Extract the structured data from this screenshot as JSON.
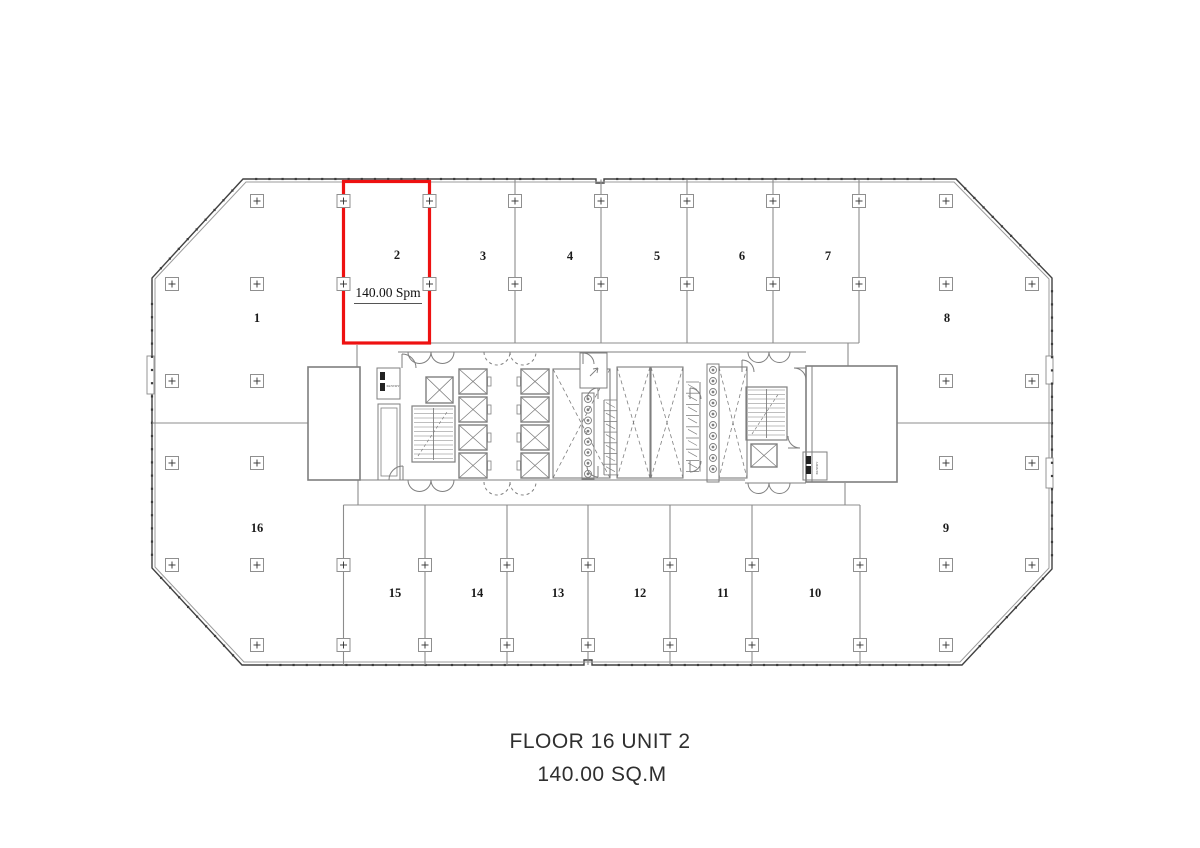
{
  "title": {
    "line1": "FLOOR 16 UNIT 2",
    "line2": "140.00 SQ.M"
  },
  "highlighted_unit": {
    "number": "2",
    "area_label": "140.00 Spm",
    "color": "#ee1111"
  },
  "units": [
    {
      "number": "1",
      "x": 257,
      "y": 322
    },
    {
      "number": "2",
      "x": 397,
      "y": 259
    },
    {
      "number": "3",
      "x": 483,
      "y": 260
    },
    {
      "number": "4",
      "x": 570,
      "y": 260
    },
    {
      "number": "5",
      "x": 657,
      "y": 260
    },
    {
      "number": "6",
      "x": 742,
      "y": 260
    },
    {
      "number": "7",
      "x": 828,
      "y": 260
    },
    {
      "number": "8",
      "x": 947,
      "y": 322
    },
    {
      "number": "9",
      "x": 946,
      "y": 532
    },
    {
      "number": "10",
      "x": 815,
      "y": 597
    },
    {
      "number": "11",
      "x": 723,
      "y": 597
    },
    {
      "number": "12",
      "x": 640,
      "y": 597
    },
    {
      "number": "13",
      "x": 558,
      "y": 597
    },
    {
      "number": "14",
      "x": 477,
      "y": 597
    },
    {
      "number": "15",
      "x": 395,
      "y": 597
    },
    {
      "number": "16",
      "x": 257,
      "y": 532
    }
  ],
  "core_labels": [
    {
      "text": "PANTRY",
      "x": 393,
      "y": 387,
      "vertical": false
    },
    {
      "text": "PANTRY",
      "x": 818,
      "y": 468,
      "vertical": true
    }
  ],
  "column_marker_rows": [
    {
      "y": 201,
      "xs": [
        257,
        343.5,
        429.5,
        515,
        601,
        687,
        773,
        859,
        946
      ]
    },
    {
      "y": 284,
      "xs": [
        172,
        257,
        343.5,
        429.5,
        515,
        601,
        687,
        773,
        859,
        946,
        1032
      ]
    },
    {
      "y": 381,
      "xs": [
        172,
        257,
        946,
        1032
      ]
    },
    {
      "y": 463,
      "xs": [
        172,
        257,
        946,
        1032
      ]
    },
    {
      "y": 565,
      "xs": [
        172,
        257,
        343.5,
        425,
        507,
        588,
        670,
        752,
        860,
        946,
        1032
      ]
    },
    {
      "y": 645,
      "xs": [
        257,
        343.5,
        425,
        507,
        588,
        670,
        752,
        860,
        946
      ]
    }
  ],
  "colors": {
    "highlight": "#ee1111",
    "interior_line": "#8c8c8c",
    "wall_outer": "#414141",
    "wall_inner": "#9b9b9b",
    "marker_box": "#8f8f8f",
    "marker_cross": "#2e2e2e",
    "unit_text": "#1b1b1b",
    "title_text": "#2f2f2f",
    "core_line": "#7f7f7f"
  }
}
